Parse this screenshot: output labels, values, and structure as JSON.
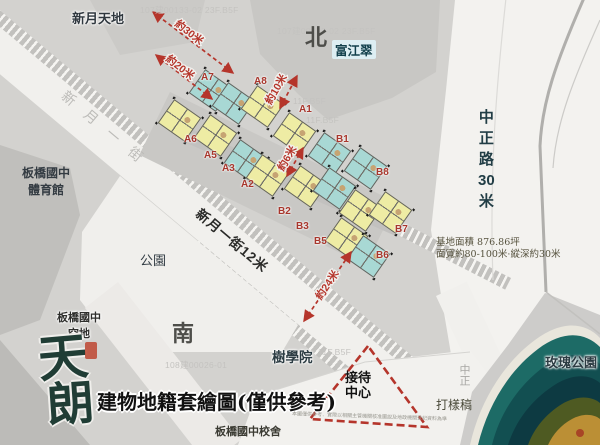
{
  "title": {
    "map_title": "建物地籍套繪圖(僅供參考)"
  },
  "logo": {
    "site_line1": "板橋國中",
    "site_line2": "空地",
    "brand_char1": "天",
    "brand_char2": "朗"
  },
  "compass": {
    "north": "北",
    "south": "南"
  },
  "roads": {
    "xinyue_street_faint": "新月一街",
    "xinyue_street": "新月一街12米",
    "zhongzheng_chars": [
      "中",
      "正",
      "路",
      "30",
      "米"
    ],
    "zhongzheng_faint": "中正"
  },
  "places": {
    "xinyue_tiandi": "新月天地",
    "fujiangcui": "富江翠",
    "gym_line1": "板橋國中",
    "gym_line2": "體育館",
    "park": "公園",
    "tree_academy": "樹學院",
    "rose_park": "玫瑰公園",
    "school_building": "板橋國中校舍",
    "proof_label": "打樣稿"
  },
  "reception": {
    "line1": "接待",
    "line2": "中心"
  },
  "site_info": {
    "area_line": "基地面積 876.86坪",
    "dim_line": "面寬約80-100米·縱深約30米"
  },
  "measurements": {
    "m30": "約30米",
    "m20": "約20米",
    "m10": "約10米",
    "m6": "約6米",
    "m24": "約24米"
  },
  "buildings": {
    "a": [
      "A7",
      "A8",
      "A1",
      "A6",
      "A5",
      "A3",
      "A2"
    ],
    "b": [
      "B1",
      "B8",
      "B7",
      "B2",
      "B3",
      "B5",
      "B6"
    ]
  },
  "cadastral": {
    "c1": "107建00133-02   23F.B5F",
    "c2": "107建00133-02   23F.B5F",
    "c3": "11F.B5F",
    "c4": "11F.B5F",
    "c5": "108建00026-01",
    "c6": "11F.B5F"
  },
  "disclaimer": "本圖僅供參考．實際以相關主管機關核准圖說及地政機關登記資料為準",
  "colors": {
    "accent_red": "#b5352b",
    "unit_yellow": "#eeeca4",
    "unit_cyan": "#a8d8d4",
    "logo_green": "#203d35",
    "land_gray": "#d3d2cf",
    "road_white": "#f1f0ed",
    "mountain_teal": "#1d6b66"
  }
}
